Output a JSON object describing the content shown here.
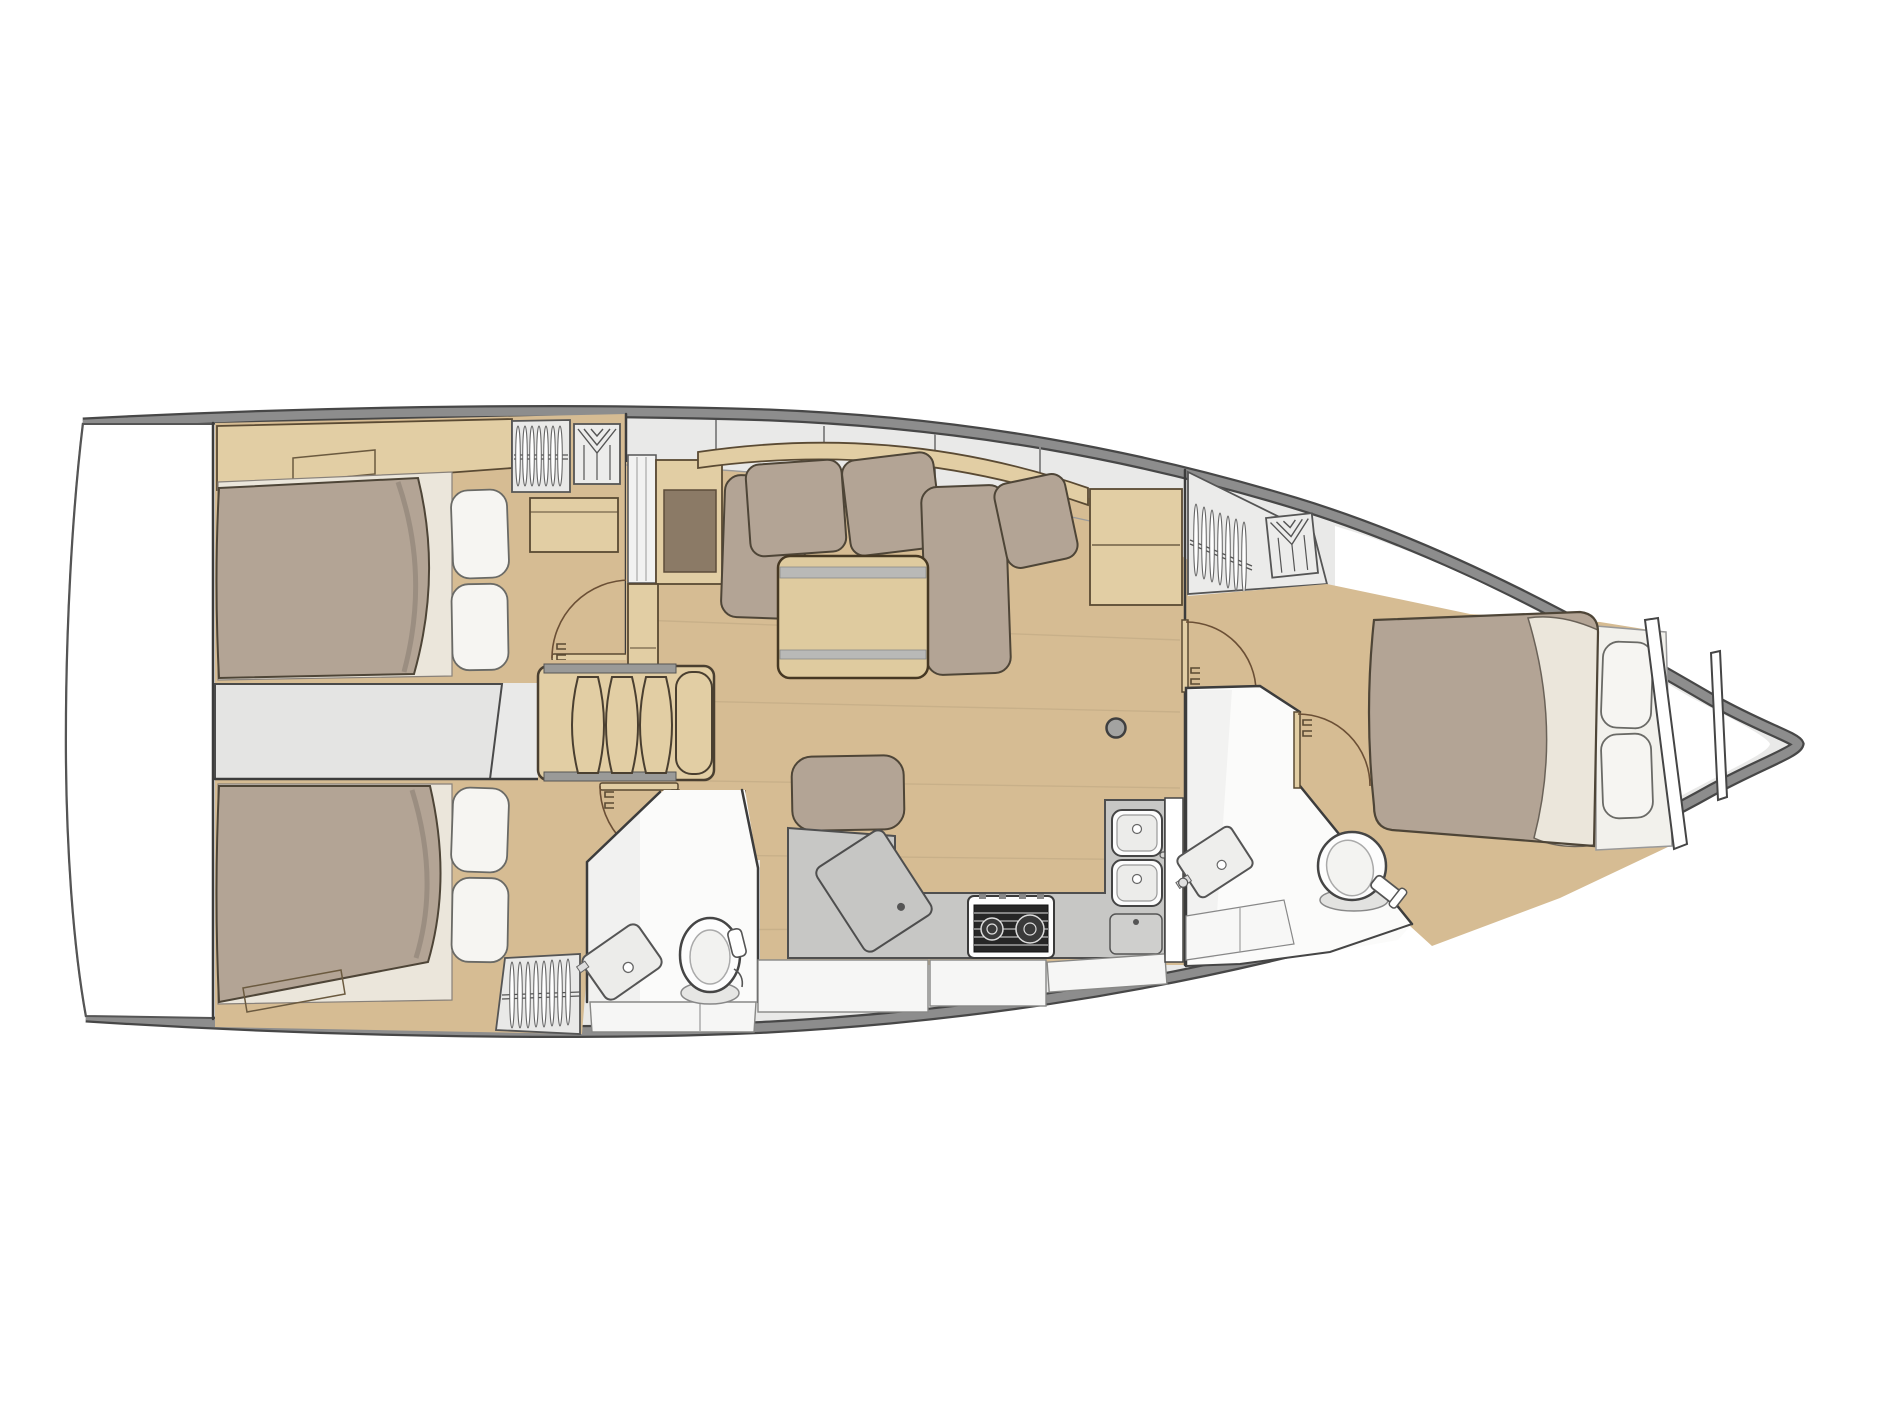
{
  "meta": {
    "title": "Sailing yacht interior layout - top-down floor plan, bow pointing right",
    "diagram_type": "boat-floor-plan",
    "orientation": "bow-right"
  },
  "colors": {
    "canvas_bg": "#ffffff",
    "hull_band": "#8d8d8d",
    "hull_edge": "#474747",
    "deck_gray": "#e9e9e8",
    "wall_line": "#3c3c3c",
    "wood_floor": "#d6bc93",
    "wood_furniture": "#e2cea4",
    "wood_table": "#dfcb9f",
    "wood_edge": "#5a4a33",
    "mattress": "#b3a495",
    "sheet": "#ebe6db",
    "pillow": "#f6f5f2",
    "panel_brown": "#8b7a66",
    "engine_gray": "#e4e4e3",
    "counter_gray": "#c7c7c5",
    "appliance_white": "#fdfdfd",
    "stove_black": "#262626",
    "bath_white": "#fbfbfa",
    "fixture_gray": "#ececea",
    "cabinet_white": "#f6f6f5",
    "arc_brown": "#6b4f35",
    "hatch_gray": "#a3a3a1"
  },
  "areas": [
    {
      "id": "swim-platform",
      "label": "Swim platform / transom"
    },
    {
      "id": "aft-cabin-port",
      "label": "Aft cabin (port) with double berth, pillows, hanging locker and wardrobe"
    },
    {
      "id": "engine-compartment",
      "label": "Engine compartment under cockpit"
    },
    {
      "id": "companionway-steps",
      "label": "Companionway steps"
    },
    {
      "id": "aft-cabin-starboard",
      "label": "Aft cabin (starboard) with double berth, pillows and hanging wardrobe"
    },
    {
      "id": "aft-head",
      "label": "Aft head with toilet and washbasin"
    },
    {
      "id": "saloon",
      "label": "Saloon with L-shaped settee, folding table and ottoman"
    },
    {
      "id": "nav-station",
      "label": "Chart / nav table"
    },
    {
      "id": "galley",
      "label": "Galley with two-burner stove, double sink and lockers"
    },
    {
      "id": "forward-head",
      "label": "Forward head with toilet and washbasin"
    },
    {
      "id": "forward-cabin",
      "label": "Forward owner's cabin with double berth and hanging locker"
    },
    {
      "id": "bow-locker",
      "label": "Bow anchor locker with collision bulkheads"
    }
  ],
  "icons": [
    "bed-double-icon",
    "pillow-icon",
    "hanger-rail-icon",
    "shirt-locker-icon",
    "steps-icon",
    "door-swing-icon",
    "toilet-icon",
    "washbasin-icon",
    "stove-2-burner-icon",
    "double-sink-icon",
    "faucet-icon",
    "sofa-cushion-icon",
    "table-icon",
    "chart-table-icon",
    "floor-hatch-icon"
  ]
}
